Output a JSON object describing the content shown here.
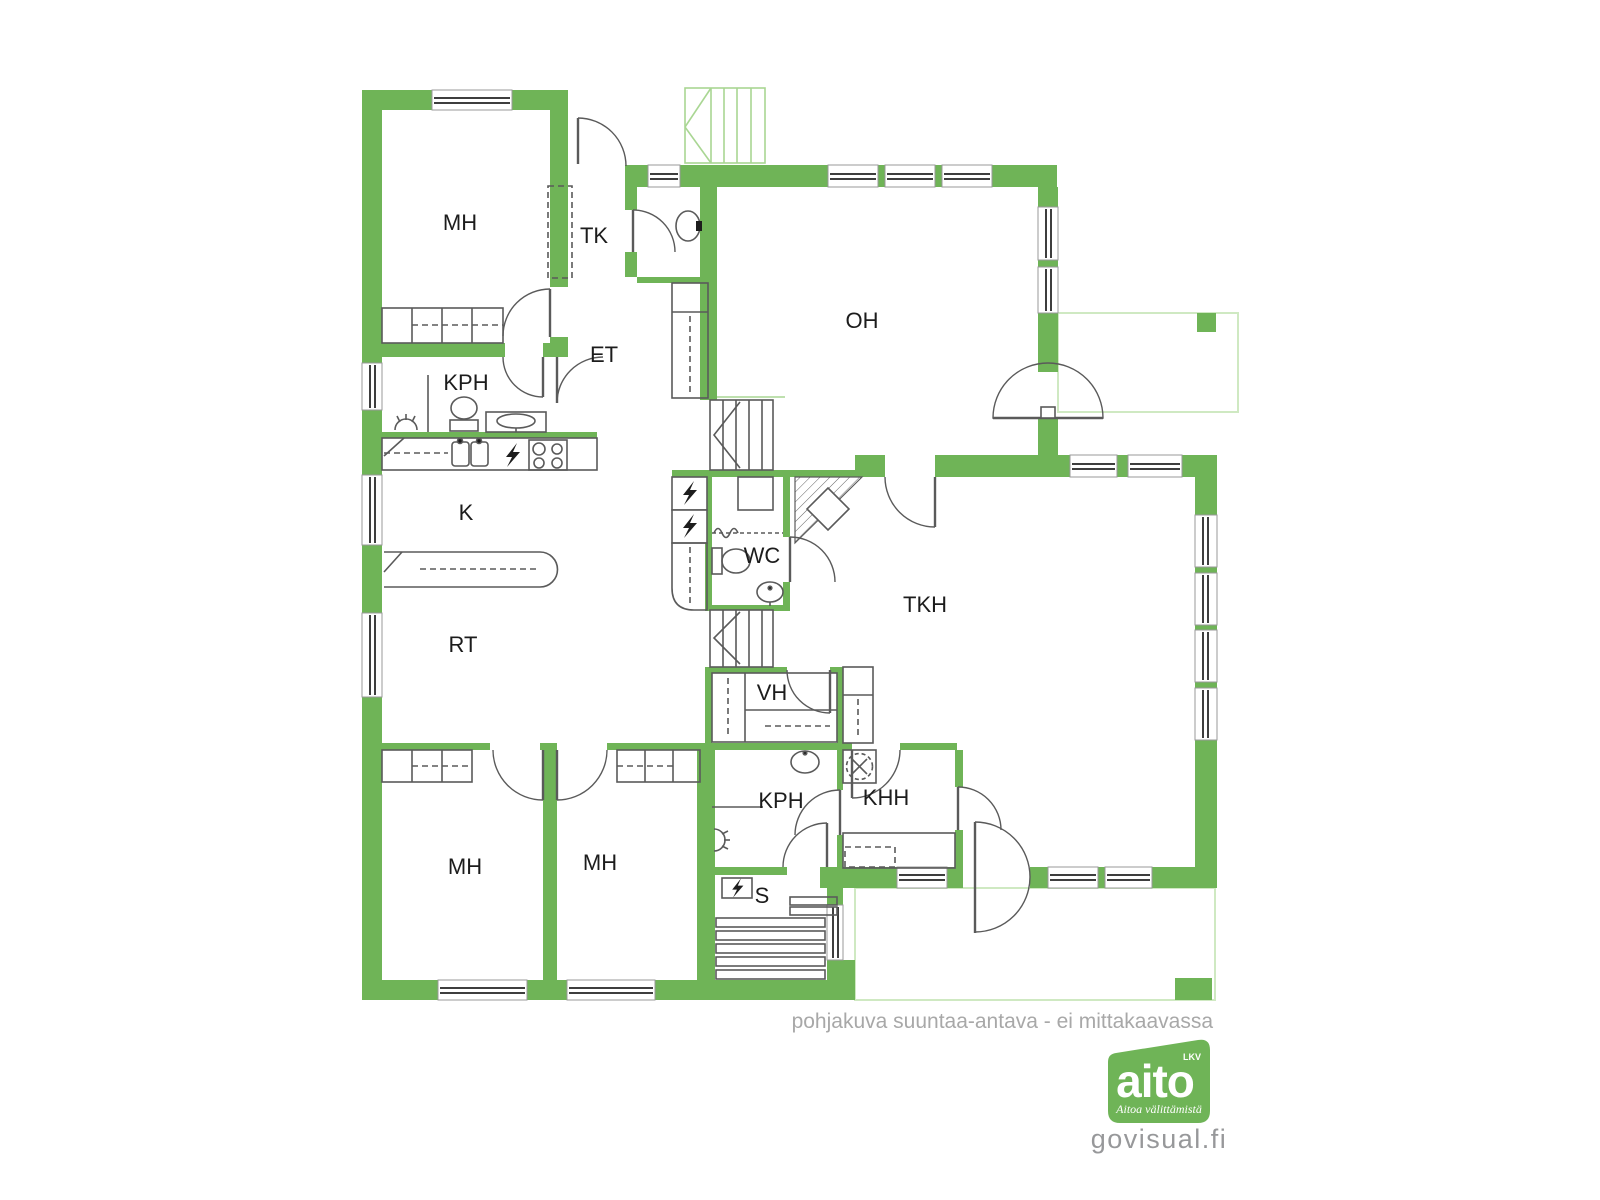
{
  "plan": {
    "rooms": [
      {
        "id": "mh-top",
        "label": "MH"
      },
      {
        "id": "tk",
        "label": "TK"
      },
      {
        "id": "oh",
        "label": "OH"
      },
      {
        "id": "kph-top",
        "label": "KPH"
      },
      {
        "id": "et",
        "label": "ET"
      },
      {
        "id": "k",
        "label": "K"
      },
      {
        "id": "wc",
        "label": "WC"
      },
      {
        "id": "tkh",
        "label": "TKH"
      },
      {
        "id": "rt",
        "label": "RT"
      },
      {
        "id": "vh",
        "label": "VH"
      },
      {
        "id": "kph-bottom",
        "label": "KPH"
      },
      {
        "id": "khh",
        "label": "KHH"
      },
      {
        "id": "s",
        "label": "S"
      },
      {
        "id": "mh-bottom-left",
        "label": "MH"
      },
      {
        "id": "mh-bottom-mid",
        "label": "MH"
      }
    ],
    "disclaimer": "pohjakuva suuntaa-antava - ei mittakaavassa"
  },
  "branding": {
    "logo_text": "aito",
    "logo_suffix": "LKV",
    "logo_tagline": "Aitoa välittämistä",
    "website": "govisual.fi"
  },
  "colors": {
    "wall_green": "#6fb457",
    "light_green": "#a9d693",
    "pale_green": "#cfe9c2",
    "line_gray": "#5a5a5a",
    "window_dark": "#3e3e3e",
    "label_text": "#1c1c1c",
    "muted_text": "#a8a8a8",
    "logo_gray": "#97989a"
  }
}
